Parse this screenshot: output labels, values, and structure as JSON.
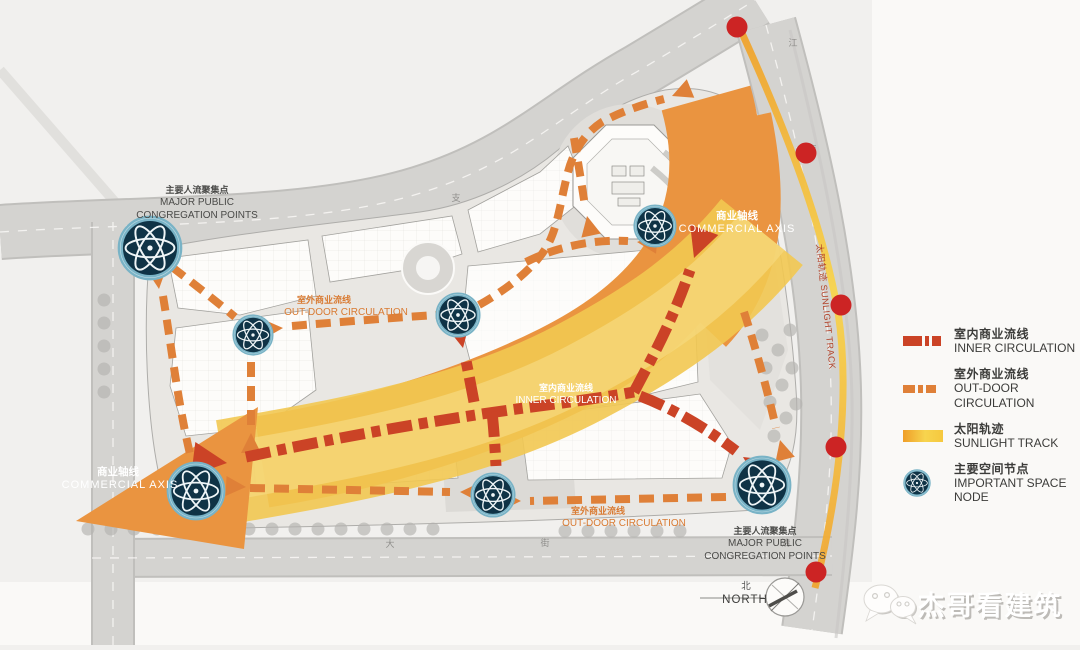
{
  "legend": {
    "items": [
      {
        "zh": "室内商业流线",
        "en": "INNER CIRCULATION",
        "type": "inner-circulation"
      },
      {
        "zh": "室外商业流线",
        "en": "OUT-DOOR CIRCULATION",
        "type": "outdoor-circulation"
      },
      {
        "zh": "太阳轨迹",
        "en": "SUNLIGHT TRACK",
        "type": "sunlight-track"
      },
      {
        "zh": "主要空间节点",
        "en": "IMPORTANT SPACE NODE",
        "type": "space-node"
      }
    ]
  },
  "plan_labels": {
    "major_public_tl": {
      "zh": "主要人流聚集点",
      "en1": "MAJOR PUBLIC",
      "en2": "CONGREGATION POINTS"
    },
    "major_public_br": {
      "zh": "主要人流聚集点",
      "en1": "MAJOR PUBLIC",
      "en2": "CONGREGATION POINTS"
    },
    "commercial_axis_ne": {
      "zh": "商业轴线",
      "en": "COMMERCIAL AXIS"
    },
    "commercial_axis_sw": {
      "zh": "商业轴线",
      "en": "COMMERCIAL AXIS"
    },
    "outdoor_w": {
      "zh": "室外商业流线",
      "en": "OUT-DOOR CIRCULATION"
    },
    "outdoor_s": {
      "zh": "室外商业流线",
      "en": "OUT-DOOR CIRCULATION"
    },
    "inner_c": {
      "zh": "室内商业流线",
      "en": "INNER CIRCULATION"
    },
    "sunlight_track": {
      "text": "太阳轨迹 SUNLIGHT TRACK"
    },
    "north": {
      "zh": "北",
      "en": "NORTH"
    }
  },
  "watermark": {
    "text": "杰哥看建筑",
    "icon": "wechat-icon"
  },
  "nodes": [
    {
      "x": 150,
      "y": 248,
      "r": 33
    },
    {
      "x": 253,
      "y": 335,
      "r": 21
    },
    {
      "x": 458,
      "y": 315,
      "r": 23
    },
    {
      "x": 655,
      "y": 226,
      "r": 22
    },
    {
      "x": 493,
      "y": 495,
      "r": 23
    },
    {
      "x": 196,
      "y": 491,
      "r": 30
    },
    {
      "x": 762,
      "y": 485,
      "r": 30
    }
  ],
  "sun_dots": [
    {
      "x": 737,
      "y": 27
    },
    {
      "x": 806,
      "y": 153
    },
    {
      "x": 841,
      "y": 305
    },
    {
      "x": 836,
      "y": 447
    },
    {
      "x": 816,
      "y": 572
    }
  ],
  "road_labels": [
    {
      "text": "支",
      "x": 456,
      "y": 201
    },
    {
      "text": "江",
      "x": 793,
      "y": 46
    },
    {
      "text": "南",
      "x": 812,
      "y": 152
    },
    {
      "text": "大",
      "x": 390,
      "y": 547
    },
    {
      "text": "街",
      "x": 545,
      "y": 546
    },
    {
      "text": "清",
      "x": 786,
      "y": 546
    }
  ],
  "colors": {
    "inner_circulation": "#cb4326",
    "outdoor_circulation": "#df8038",
    "sunlight_from": "#ef9e28",
    "sunlight_to": "#f7d44e",
    "commercial_axis_band": "#ea9440",
    "sunlight_band": "#f2c851",
    "node_fill": "#0f3346",
    "node_ring": "#79b3c6",
    "sun_dot": "#cc2424"
  }
}
